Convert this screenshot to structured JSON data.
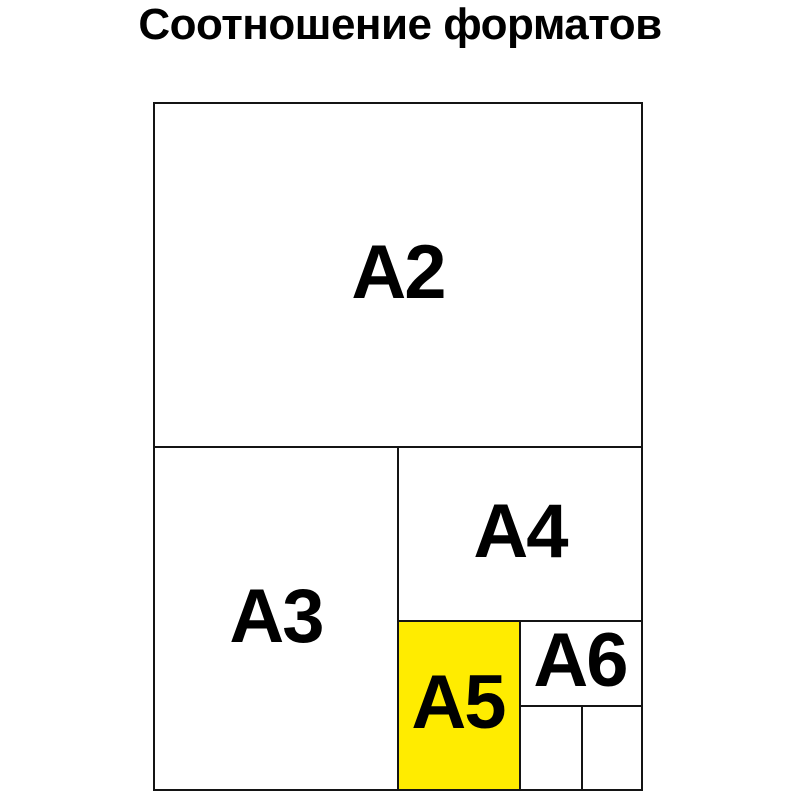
{
  "title": "Соотношение форматов",
  "colors": {
    "highlight": "#ffec00",
    "line": "#141414",
    "background": "#ffffff",
    "text": "#000000"
  },
  "diagram": {
    "formats": [
      {
        "label": "A2",
        "highlighted": false
      },
      {
        "label": "A3",
        "highlighted": false
      },
      {
        "label": "A4",
        "highlighted": false
      },
      {
        "label": "A5",
        "highlighted": true
      },
      {
        "label": "A6",
        "highlighted": false
      }
    ],
    "empty_subdivision_cells": 2
  }
}
